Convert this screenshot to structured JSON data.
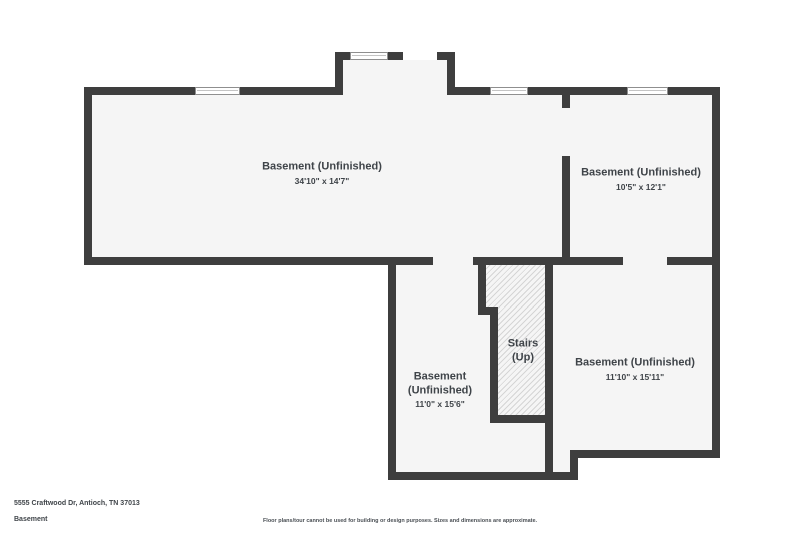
{
  "floorplan": {
    "rooms": [
      {
        "id": "basement-large",
        "name": "Basement (Unfinished)",
        "dims": "34'10\" x 14'7\""
      },
      {
        "id": "basement-top-right",
        "name": "Basement (Unfinished)",
        "dims": "10'5\" x 12'1\""
      },
      {
        "id": "basement-bottom-left",
        "name": "Basement (Unfinished)",
        "dims": "11'0\" x 15'6\""
      },
      {
        "id": "stairs",
        "name": "Stairs (Up)"
      },
      {
        "id": "basement-bottom-right",
        "name": "Basement (Unfinished)",
        "dims": "11'10\" x 15'11\""
      }
    ],
    "colors": {
      "wall": "#3e3e3e",
      "floor": "#f5f5f5",
      "hatch_line": "#d5d5d5",
      "label": "#3f4449",
      "background": "#ffffff"
    }
  },
  "footer": {
    "address": "5555 Craftwood Dr, Antioch, TN 37013",
    "level": "Basement",
    "disclaimer": "Floor plans/tour cannot be used for building or design purposes. Sizes and dimensions are approximate."
  }
}
